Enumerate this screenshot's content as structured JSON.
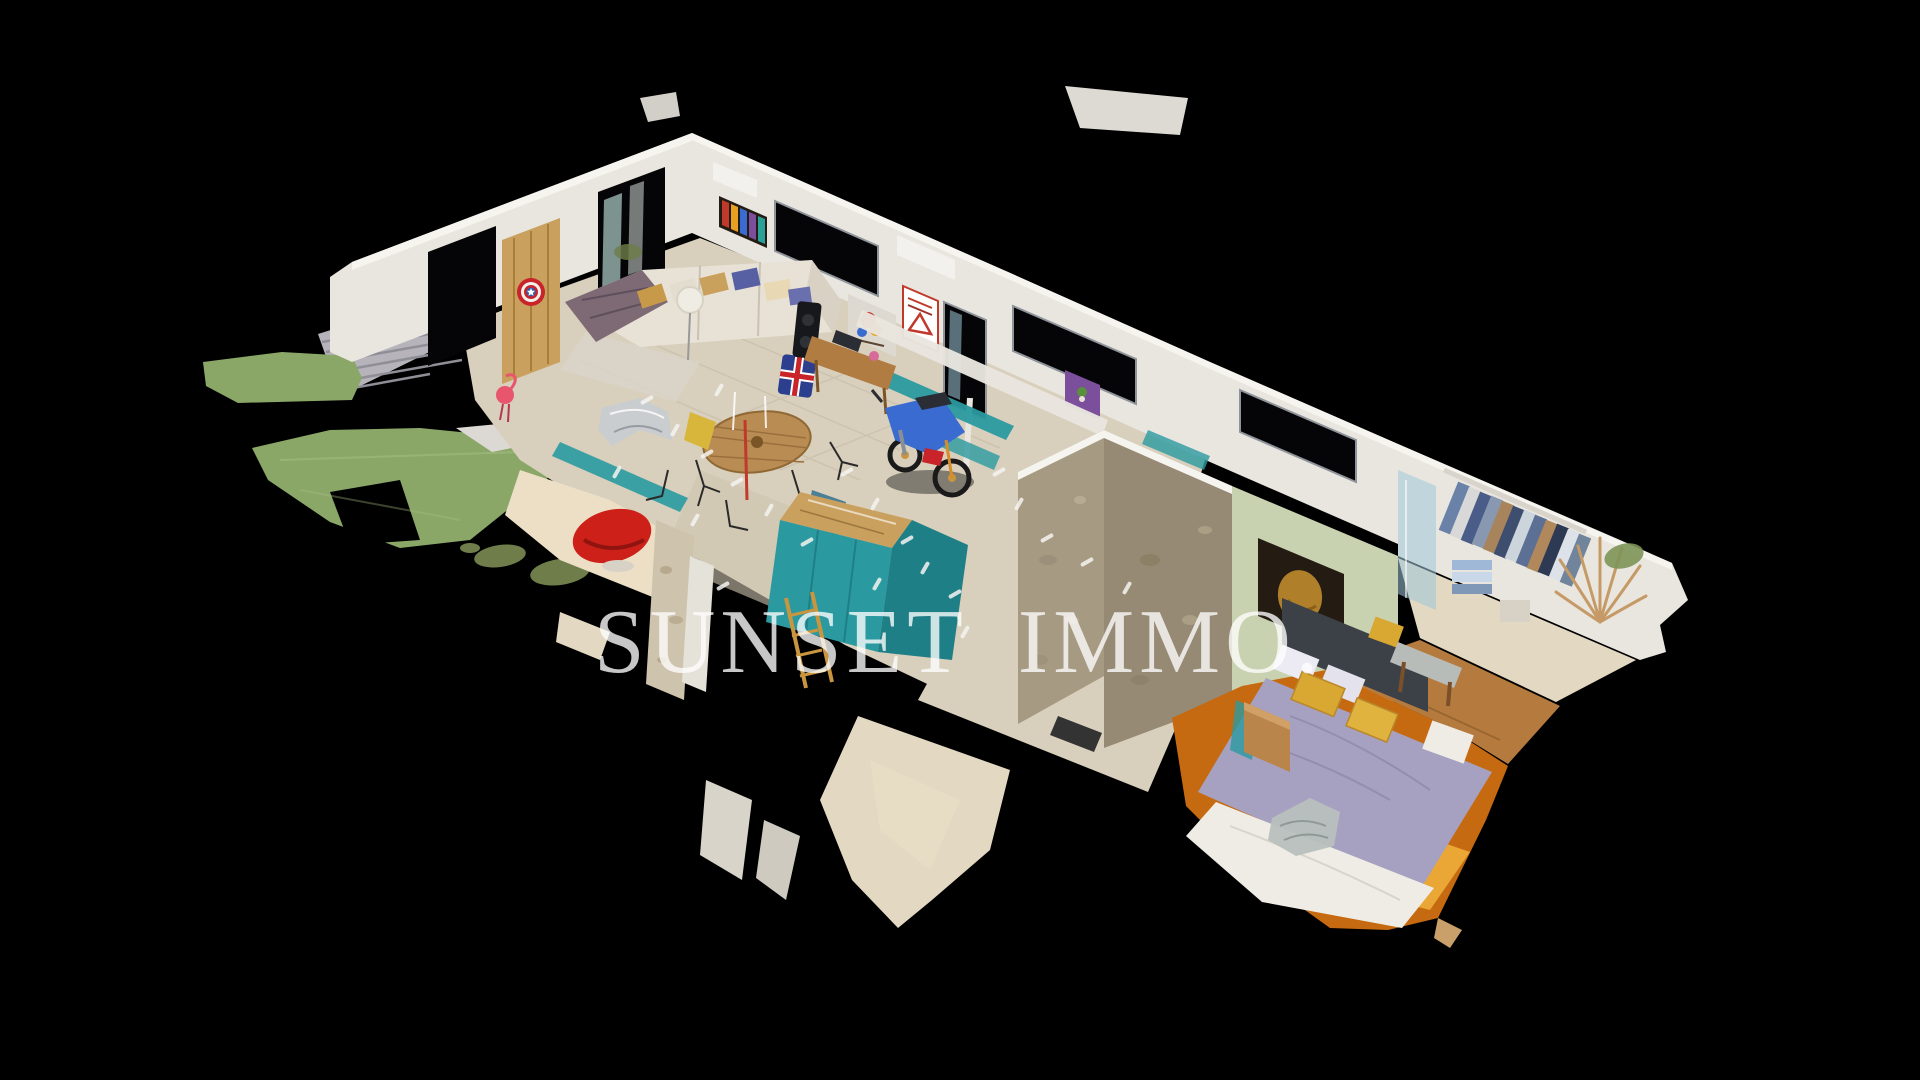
{
  "watermark": {
    "text": "SUNSET IMMO.",
    "color": "#ffffff"
  },
  "scene": {
    "background": "#000000",
    "palette": {
      "wall": "#e9e6df",
      "wallShade": "#d8d2c8",
      "wallTop": "#f6f4ef",
      "windowDark": "#050507",
      "frame": "#8f949b",
      "glass": "#bfe0da",
      "glassBlue": "#9fc6d8",
      "floor": "#d8cfbc",
      "floorDark": "#cfc5b0",
      "floorLight": "#ecdfc6",
      "fragment": "#e3d8c2",
      "grass": "#8aa768",
      "grassDark": "#6e7d49",
      "deck": "#b6b4ba",
      "deckLine": "#908e96",
      "wood": "#b07c42",
      "woodLight": "#c9a05e",
      "tealCab": "#2a9aa0",
      "tealDark": "#1f7f86",
      "stone": "#a79a83",
      "stoneDark": "#968a74",
      "greenWall": "#c9d2b0",
      "carpet": "#c56a10",
      "carpetSun": "#f0b23c",
      "bedLavender": "#a7a1c1",
      "duvet": "#efece6",
      "pillowYellow": "#d9a832",
      "sofa": "#e8e2d6",
      "throw": "#7e6a74",
      "redChair": "#cc2018",
      "shieldRed": "#c8242a",
      "shieldBlue": "#2d5fb0",
      "motoBlue": "#3a6bd0",
      "dark": "#17181c",
      "posterPurple": "#7b4f9c",
      "artGold": "#c9912f",
      "artDark": "#241c12",
      "pink": "#e8566e",
      "white": "#f5f4f1",
      "chrome": "#c9ccd1"
    }
  }
}
